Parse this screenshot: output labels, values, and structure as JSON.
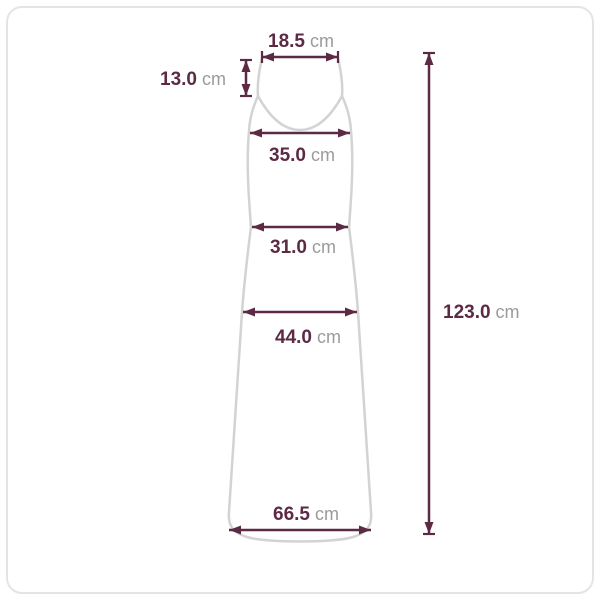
{
  "diagram": {
    "colors": {
      "measure": "#5d2a45",
      "unit_text": "#9b9b9b",
      "garment_outline": "#d3d3d3",
      "frame_border": "#e4e4e4",
      "background": "#ffffff"
    },
    "measurements": {
      "top_width": {
        "value": "18.5",
        "unit": "cm"
      },
      "strap_length": {
        "value": "13.0",
        "unit": "cm"
      },
      "bust_width": {
        "value": "35.0",
        "unit": "cm"
      },
      "waist_width": {
        "value": "31.0",
        "unit": "cm"
      },
      "hip_width": {
        "value": "44.0",
        "unit": "cm"
      },
      "hem_width": {
        "value": "66.5",
        "unit": "cm"
      },
      "total_length": {
        "value": "123.0",
        "unit": "cm"
      }
    }
  }
}
